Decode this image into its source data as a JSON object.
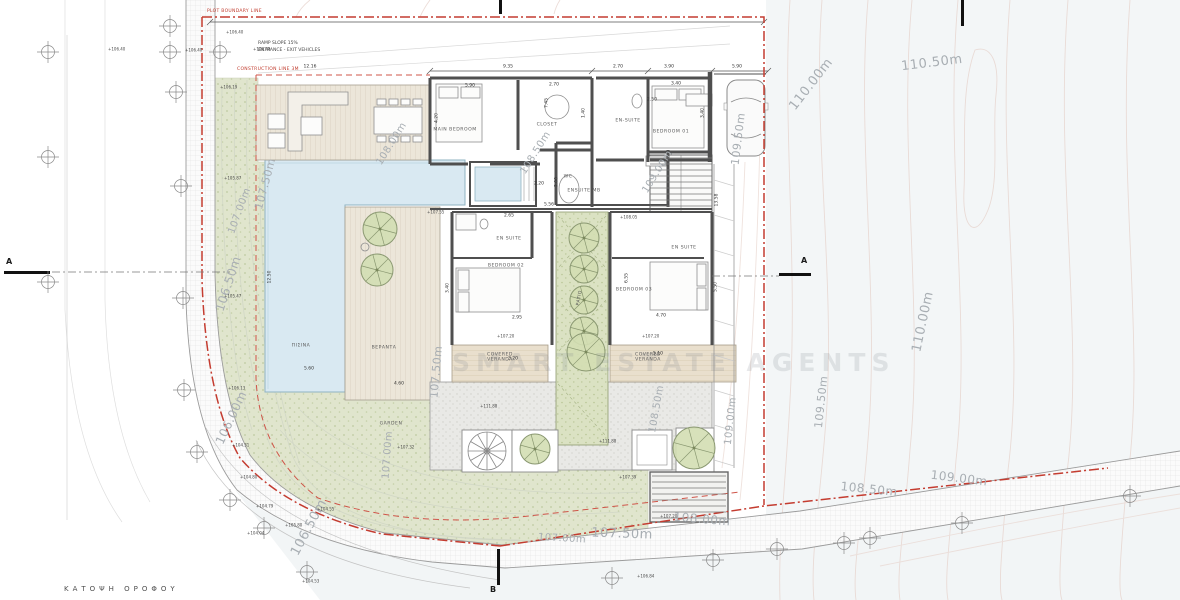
{
  "meta": {
    "plan_title": "ΚΑΤΟΨΗ ΟΡΟΦΟΥ",
    "watermark": "SMART ESTATE AGENTS"
  },
  "annotations": {
    "plot_boundary": "PLOT BOUNDARY LINE",
    "construction_line": "CONSTRUCTION LINE 3M",
    "ramp_line1": "RAMP SLOPE 15%",
    "ramp_line2": "ENTRANCE - EXIT VEHICLES"
  },
  "sections": {
    "left_a": "A",
    "right_a": "A",
    "bottom_b": "B"
  },
  "colors": {
    "boundary_red": "#c43c30",
    "construction_red": "#cf5448",
    "garden_green": "#e0e5cd",
    "pool_blue": "#d9e9f2",
    "wall_gray": "#4f4f4f",
    "contour_text": "#a8aeb3",
    "neighbor_plot": "#f3f6f7"
  },
  "room_labels": [
    {
      "text": "MAIN BEDROOM",
      "x": 455,
      "y": 130
    },
    {
      "text": "CLOSET",
      "x": 547,
      "y": 125
    },
    {
      "text": "EN-SUITE",
      "x": 628,
      "y": 121
    },
    {
      "text": "BEDROOM 01",
      "x": 671,
      "y": 132
    },
    {
      "text": "WC",
      "x": 568,
      "y": 177
    },
    {
      "text": "ENSUITE MB",
      "x": 584,
      "y": 191
    },
    {
      "text": "EN SUITE",
      "x": 509,
      "y": 239
    },
    {
      "text": "EN SUITE",
      "x": 684,
      "y": 248
    },
    {
      "text": "BEDROOM 02",
      "x": 506,
      "y": 266
    },
    {
      "text": "BEDROOM 03",
      "x": 634,
      "y": 290
    },
    {
      "text": "COVERED\nVERANDA",
      "x": 500,
      "y": 358
    },
    {
      "text": "COVERED\nVERANDA",
      "x": 648,
      "y": 358
    },
    {
      "text": "ΠΙΣΙΝΑ",
      "x": 301,
      "y": 346
    },
    {
      "text": "ΒΕΡΑΝΤΑ",
      "x": 384,
      "y": 348
    },
    {
      "text": "GARDEN",
      "x": 391,
      "y": 424
    },
    {
      "text": "PATIO",
      "x": 580,
      "y": 298,
      "rot": -80
    }
  ],
  "contour_labels": [
    {
      "text": "110.50m",
      "x": 932,
      "y": 64,
      "rot": -7,
      "size": 13
    },
    {
      "text": "110.00m",
      "x": 812,
      "y": 85,
      "rot": -52,
      "size": 13
    },
    {
      "text": "110.00m",
      "x": 924,
      "y": 322,
      "rot": -78,
      "size": 13
    },
    {
      "text": "109.50m",
      "x": 739,
      "y": 139,
      "rot": -83,
      "size": 11
    },
    {
      "text": "109.50m",
      "x": 822,
      "y": 402,
      "rot": -84,
      "size": 11
    },
    {
      "text": "109.00m",
      "x": 731,
      "y": 421,
      "rot": -84,
      "size": 10
    },
    {
      "text": "109.00m",
      "x": 959,
      "y": 479,
      "rot": 7,
      "size": 12
    },
    {
      "text": "108.50m",
      "x": 657,
      "y": 409,
      "rot": -80,
      "size": 10
    },
    {
      "text": "108.50m",
      "x": 869,
      "y": 490,
      "rot": 6,
      "size": 12
    },
    {
      "text": "108.00m",
      "x": 702,
      "y": 520,
      "rot": 5,
      "size": 12
    },
    {
      "text": "108.00m",
      "x": 392,
      "y": 144,
      "rot": -58,
      "size": 10
    },
    {
      "text": "108.50m",
      "x": 536,
      "y": 153,
      "rot": -58,
      "size": 10
    },
    {
      "text": "109.00m",
      "x": 658,
      "y": 172,
      "rot": -58,
      "size": 10
    },
    {
      "text": "107.50m",
      "x": 266,
      "y": 184,
      "rot": -75,
      "size": 11
    },
    {
      "text": "107.00m",
      "x": 240,
      "y": 211,
      "rot": -70,
      "size": 10
    },
    {
      "text": "106.50m",
      "x": 229,
      "y": 284,
      "rot": -72,
      "size": 12
    },
    {
      "text": "106.00m",
      "x": 232,
      "y": 418,
      "rot": -65,
      "size": 12
    },
    {
      "text": "107.00m",
      "x": 388,
      "y": 455,
      "rot": -86,
      "size": 10
    },
    {
      "text": "106.50m",
      "x": 310,
      "y": 528,
      "rot": -62,
      "size": 13
    },
    {
      "text": "107.00m",
      "x": 562,
      "y": 539,
      "rot": 3,
      "size": 10
    },
    {
      "text": "107.50m",
      "x": 622,
      "y": 535,
      "rot": 2,
      "size": 13
    },
    {
      "text": "107.50m",
      "x": 437,
      "y": 372,
      "rot": -85,
      "size": 11
    }
  ],
  "spot_elevations": [
    {
      "text": "+106.40",
      "x": 226,
      "y": 33
    },
    {
      "text": "+106.40",
      "x": 108,
      "y": 50
    },
    {
      "text": "+106.40",
      "x": 185,
      "y": 51
    },
    {
      "text": "+106.40",
      "x": 253,
      "y": 50
    },
    {
      "text": "+106.19",
      "x": 220,
      "y": 88
    },
    {
      "text": "+105.87",
      "x": 224,
      "y": 179
    },
    {
      "text": "+105.47",
      "x": 224,
      "y": 297
    },
    {
      "text": "+106.13",
      "x": 228,
      "y": 389
    },
    {
      "text": "+104.31",
      "x": 232,
      "y": 446
    },
    {
      "text": "+104.80",
      "x": 240,
      "y": 478
    },
    {
      "text": "+104.79",
      "x": 256,
      "y": 507
    },
    {
      "text": "+104.55",
      "x": 317,
      "y": 510
    },
    {
      "text": "+105.80",
      "x": 285,
      "y": 526
    },
    {
      "text": "+104.04",
      "x": 247,
      "y": 534
    },
    {
      "text": "+107.32",
      "x": 397,
      "y": 448
    },
    {
      "text": "+107.55",
      "x": 427,
      "y": 213
    },
    {
      "text": "+111.88",
      "x": 480,
      "y": 407
    },
    {
      "text": "+111.88",
      "x": 599,
      "y": 442
    },
    {
      "text": "+108.05",
      "x": 620,
      "y": 218
    },
    {
      "text": "+107.20",
      "x": 497,
      "y": 337
    },
    {
      "text": "+107.20",
      "x": 642,
      "y": 337
    },
    {
      "text": "+107.39",
      "x": 619,
      "y": 478
    },
    {
      "text": "+107.20",
      "x": 660,
      "y": 517
    },
    {
      "text": "+104.53",
      "x": 302,
      "y": 582
    },
    {
      "text": "+106.84",
      "x": 637,
      "y": 577
    }
  ],
  "dimensions": [
    {
      "text": "12.16",
      "x": 310,
      "y": 67
    },
    {
      "text": "9.35",
      "x": 508,
      "y": 67
    },
    {
      "text": "2.70",
      "x": 618,
      "y": 67
    },
    {
      "text": "3.90",
      "x": 669,
      "y": 67
    },
    {
      "text": "5.90",
      "x": 737,
      "y": 67
    },
    {
      "text": "4.20",
      "x": 437,
      "y": 118,
      "rot": -90
    },
    {
      "text": "5.90",
      "x": 470,
      "y": 86
    },
    {
      "text": "2.70",
      "x": 554,
      "y": 85
    },
    {
      "text": "7.45",
      "x": 547,
      "y": 103,
      "rot": -90
    },
    {
      "text": "1.40",
      "x": 584,
      "y": 113,
      "rot": -90
    },
    {
      "text": "2.50",
      "x": 652,
      "y": 100
    },
    {
      "text": "3.40",
      "x": 676,
      "y": 84
    },
    {
      "text": "3.40",
      "x": 703,
      "y": 113,
      "rot": -90
    },
    {
      "text": "2.20",
      "x": 539,
      "y": 184
    },
    {
      "text": "2.00",
      "x": 557,
      "y": 182,
      "rot": -90
    },
    {
      "text": "5.56",
      "x": 549,
      "y": 205
    },
    {
      "text": "3.40",
      "x": 448,
      "y": 288,
      "rot": -90
    },
    {
      "text": "2.95",
      "x": 517,
      "y": 318
    },
    {
      "text": "6.55",
      "x": 627,
      "y": 278,
      "rot": -90
    },
    {
      "text": "4.70",
      "x": 661,
      "y": 316
    },
    {
      "text": "5.50",
      "x": 716,
      "y": 287,
      "rot": -90
    },
    {
      "text": "3.20",
      "x": 513,
      "y": 359
    },
    {
      "text": "5.10",
      "x": 658,
      "y": 354
    },
    {
      "text": "12.50",
      "x": 270,
      "y": 277,
      "rot": -90
    },
    {
      "text": "5.60",
      "x": 309,
      "y": 369
    },
    {
      "text": "4.60",
      "x": 399,
      "y": 384
    },
    {
      "text": "13.58",
      "x": 717,
      "y": 200,
      "rot": -90
    },
    {
      "text": "2.65",
      "x": 509,
      "y": 216
    }
  ]
}
